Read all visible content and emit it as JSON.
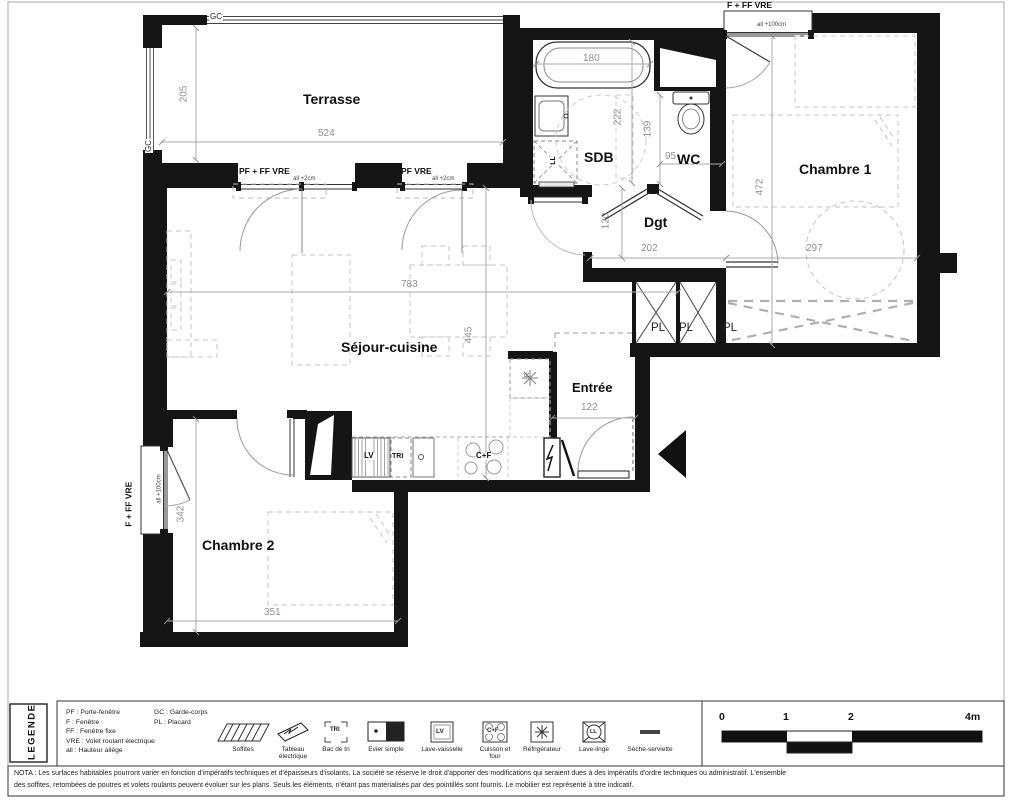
{
  "page": {
    "bg": "#ffffff",
    "wall_color": "#151515",
    "dim_color": "#8f8f8f"
  },
  "rooms": [
    {
      "label": "Terrasse"
    },
    {
      "label": "SDB"
    },
    {
      "label": "WC"
    },
    {
      "label": "Chambre 1"
    },
    {
      "label": "Dgt"
    },
    {
      "label": "Séjour-cuisine"
    },
    {
      "label": "Entrée"
    },
    {
      "label": "Chambre 2"
    }
  ],
  "dims": {
    "t_h": "205",
    "t_w": "524",
    "bain": "180",
    "sdb": "222",
    "wc_h": "139",
    "wc_w": "95",
    "c1_h": "472",
    "c1_w": "297",
    "sej_w": "783",
    "sej_h": "445",
    "dgt_h": "120",
    "dgt_w": "202",
    "ent": "122",
    "c2_h": "342",
    "c2_w": "351"
  },
  "openings": {
    "pf_ff_vre": "PF + FF  VRE",
    "pf_vre": "PF VRE",
    "f_ff_vre": "F + FF  VRE",
    "all2": "all +2cm",
    "all100": "all +100cm",
    "gc": "GC",
    "pl": "PL"
  },
  "appliances": {
    "lv": "LV",
    "tri": "TRI",
    "cf": "C+F",
    "ll": "LL",
    "r": "R"
  },
  "legend": {
    "title": "LEGENDE",
    "abbr1": [
      "PF : Porte-fenêtre",
      "F : Fenêtre",
      "FF : Fenêtre fixe",
      "VRE : Volet roulant électrique",
      "all : Hauteur allège"
    ],
    "abbr2": [
      "GC : Garde-corps",
      "PL : Placard"
    ],
    "icons": [
      "Soffites",
      "Tableau électrique",
      "Bac de tri",
      "Evier simple",
      "Lave-vaisselle",
      "Cuisson et four",
      "Réfrigérateur",
      "Lave-linge",
      "Sèche-serviette"
    ],
    "tri": "TRI",
    "lv": "LV",
    "cf": "C+F",
    "ll": "LL"
  },
  "scalebar": {
    "t0": "0",
    "t1": "1",
    "t2": "2",
    "t4": "4m"
  },
  "nota": {
    "l1": "NOTA : Les surfaces habitables pourront varier en fonction d'impératifs techniques et d'épaisseurs d'isolants. La société se réserve le droit d'apporter des modifications qui seraient dues à des impératifs d'ordre techniques ou administratif. L'ensemble",
    "l2": "des soffites, retombées de poutres et volets roulants peuvent évoluer sur les plans. Seuls les éléments, n'étant pas matérialisés par des pointillés sont fournis. Le mobilier est représenté à titre indicatif."
  }
}
